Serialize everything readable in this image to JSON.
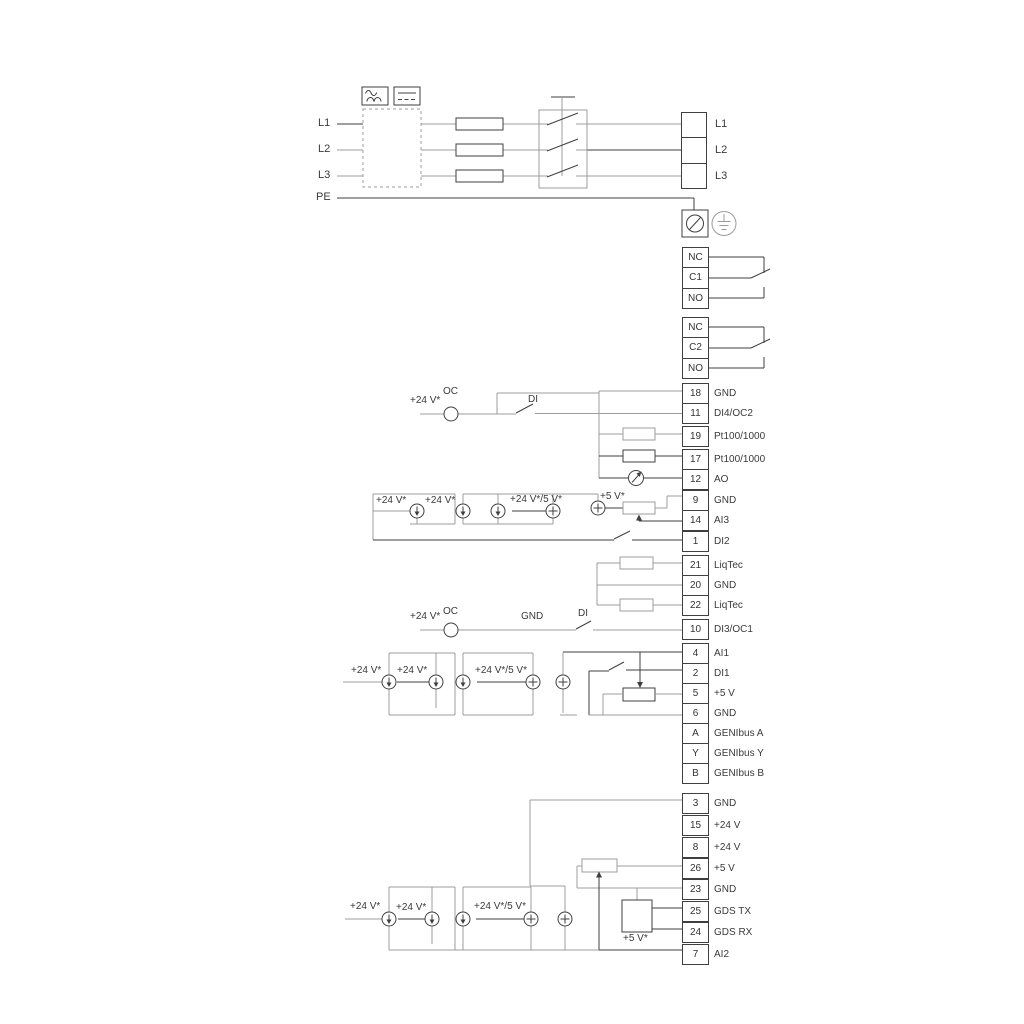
{
  "labels": {
    "l1": "L1",
    "l2": "L2",
    "l3": "L3",
    "pe": "PE",
    "oc": "OC",
    "di": "DI",
    "gnd": "GND",
    "v24": "+24 V*",
    "v24_5": "+24 V*/5 V*",
    "v5": "+5 V*"
  },
  "relays": [
    [
      "NC",
      "C1",
      "NO"
    ],
    [
      "NC",
      "C2",
      "NO"
    ]
  ],
  "terminals": {
    "io1": [
      {
        "n": "18",
        "t": "GND"
      },
      {
        "n": "11",
        "t": "DI4/OC2"
      },
      {
        "n": "19",
        "t": "Pt100/1000"
      },
      {
        "n": "17",
        "t": "Pt100/1000"
      },
      {
        "n": "12",
        "t": "AO"
      },
      {
        "n": "9",
        "t": "GND"
      },
      {
        "n": "14",
        "t": "AI3"
      },
      {
        "n": "1",
        "t": "DI2"
      }
    ],
    "liqtec": [
      {
        "n": "21",
        "t": "LiqTec"
      },
      {
        "n": "20",
        "t": "GND"
      },
      {
        "n": "22",
        "t": "LiqTec"
      }
    ],
    "di3": [
      {
        "n": "10",
        "t": "DI3/OC1"
      }
    ],
    "io2": [
      {
        "n": "4",
        "t": "AI1"
      },
      {
        "n": "2",
        "t": "DI1"
      },
      {
        "n": "5",
        "t": "+5 V"
      },
      {
        "n": "6",
        "t": "GND"
      },
      {
        "n": "A",
        "t": "GENIbus A"
      },
      {
        "n": "Y",
        "t": "GENIbus Y"
      },
      {
        "n": "B",
        "t": "GENIbus B"
      }
    ],
    "power": [
      {
        "n": "3",
        "t": "GND"
      },
      {
        "n": "15",
        "t": "+24 V"
      },
      {
        "n": "8",
        "t": "+24 V"
      },
      {
        "n": "26",
        "t": "+5 V"
      },
      {
        "n": "23",
        "t": "GND"
      },
      {
        "n": "25",
        "t": "GDS TX"
      },
      {
        "n": "24",
        "t": "GDS RX"
      },
      {
        "n": "7",
        "t": "AI2"
      }
    ]
  },
  "colors": {
    "wire_gray": "#9c9c9c",
    "wire_dark": "#3f3f3f",
    "text": "#3a3a3a"
  }
}
